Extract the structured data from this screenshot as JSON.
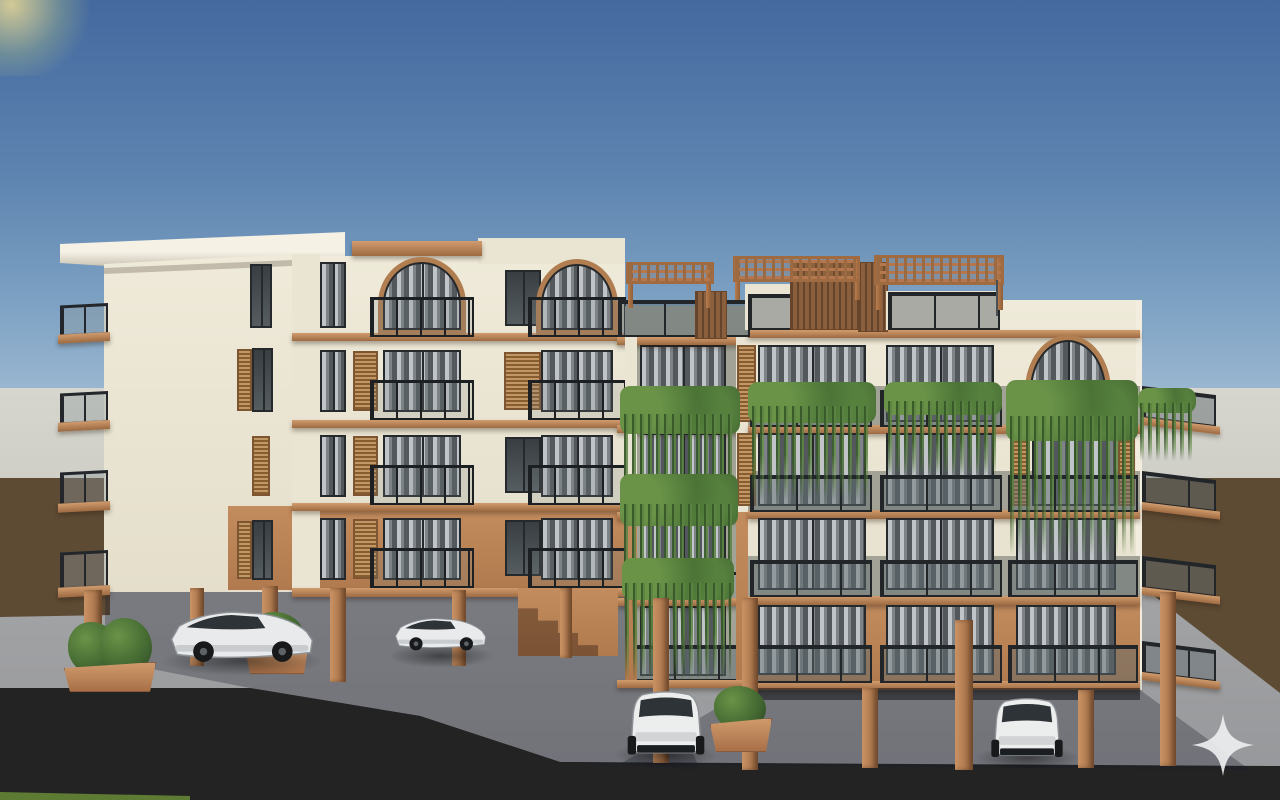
{
  "scene": {
    "type": "architectural-3d-render",
    "description": "Front elevation render of a five-storey cream and terracotta apartment building raised on pilotis, with dark-framed curtained windows, arched top-floor windows, wooden shutters, smoked-glass balcony railings, cascading green balcony plants, rooftop timber pergolas, four parked white cars in the open ground-level parking, terracotta planters with bushes, a grey boundary wall and brown fence behind, concrete forecourt and dark asphalt road in front, clear blue gradient sky above",
    "time_of_day": "day",
    "watermark": "four-point-sparkle"
  },
  "counts": {
    "visible_floors": 5,
    "cars": 4,
    "pergolas": 3,
    "hanging_plant_cascades": 7,
    "planters": 3,
    "arched_windows": 4,
    "left_side_balconies": 4,
    "right_side_balconies": 4,
    "pilotis_columns": 12
  },
  "colors": {
    "sky_top": "#44699f",
    "sky_horizon": "#b9cdde",
    "bg_wall": "#cfcfc7",
    "brown_wall": "#5e4b34",
    "concrete": "#97989b",
    "asphalt": "#232323",
    "grass": "#5e7b33",
    "wall_cream": "#efead9",
    "wall_olive": "#a2a396",
    "terracotta": "#c38c5e",
    "terracotta_dark": "#9d6a42",
    "wood": "#a9773f",
    "wood_dark": "#7d5631",
    "slat_brown": "#8a5f3d",
    "frame_dark": "#26292b",
    "rail_dark": "#1d2022",
    "glass": "#40464a",
    "foliage": "#466c33",
    "foliage_light": "#6a9348",
    "foliage_dark": "#2f4a26",
    "car_body": "#e9eaeb",
    "car_glass": "#2d3337",
    "sparkle": "#eceeef"
  }
}
